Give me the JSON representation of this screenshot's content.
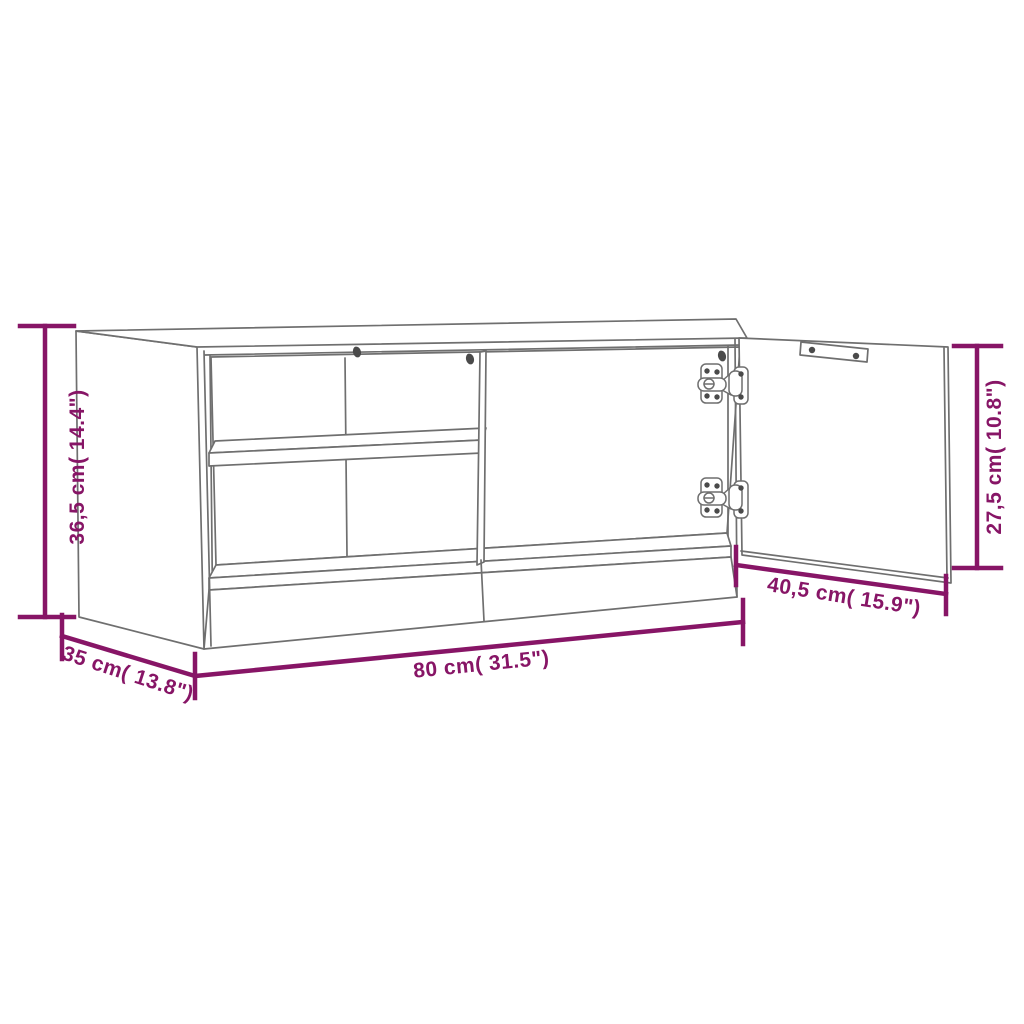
{
  "diagram": {
    "labels": {
      "height": "36,5 cm( 14.4\")",
      "width": "80 cm( 31.5\")",
      "depth": "35 cm( 13.8\")",
      "door_width": "40,5 cm( 15.9\")",
      "door_height": "27,5 cm( 10.8\")"
    },
    "colors": {
      "dimension": "#871566",
      "outline": "#6f6f6f",
      "hardware": "#4a4a4a",
      "background": "#ffffff"
    }
  }
}
